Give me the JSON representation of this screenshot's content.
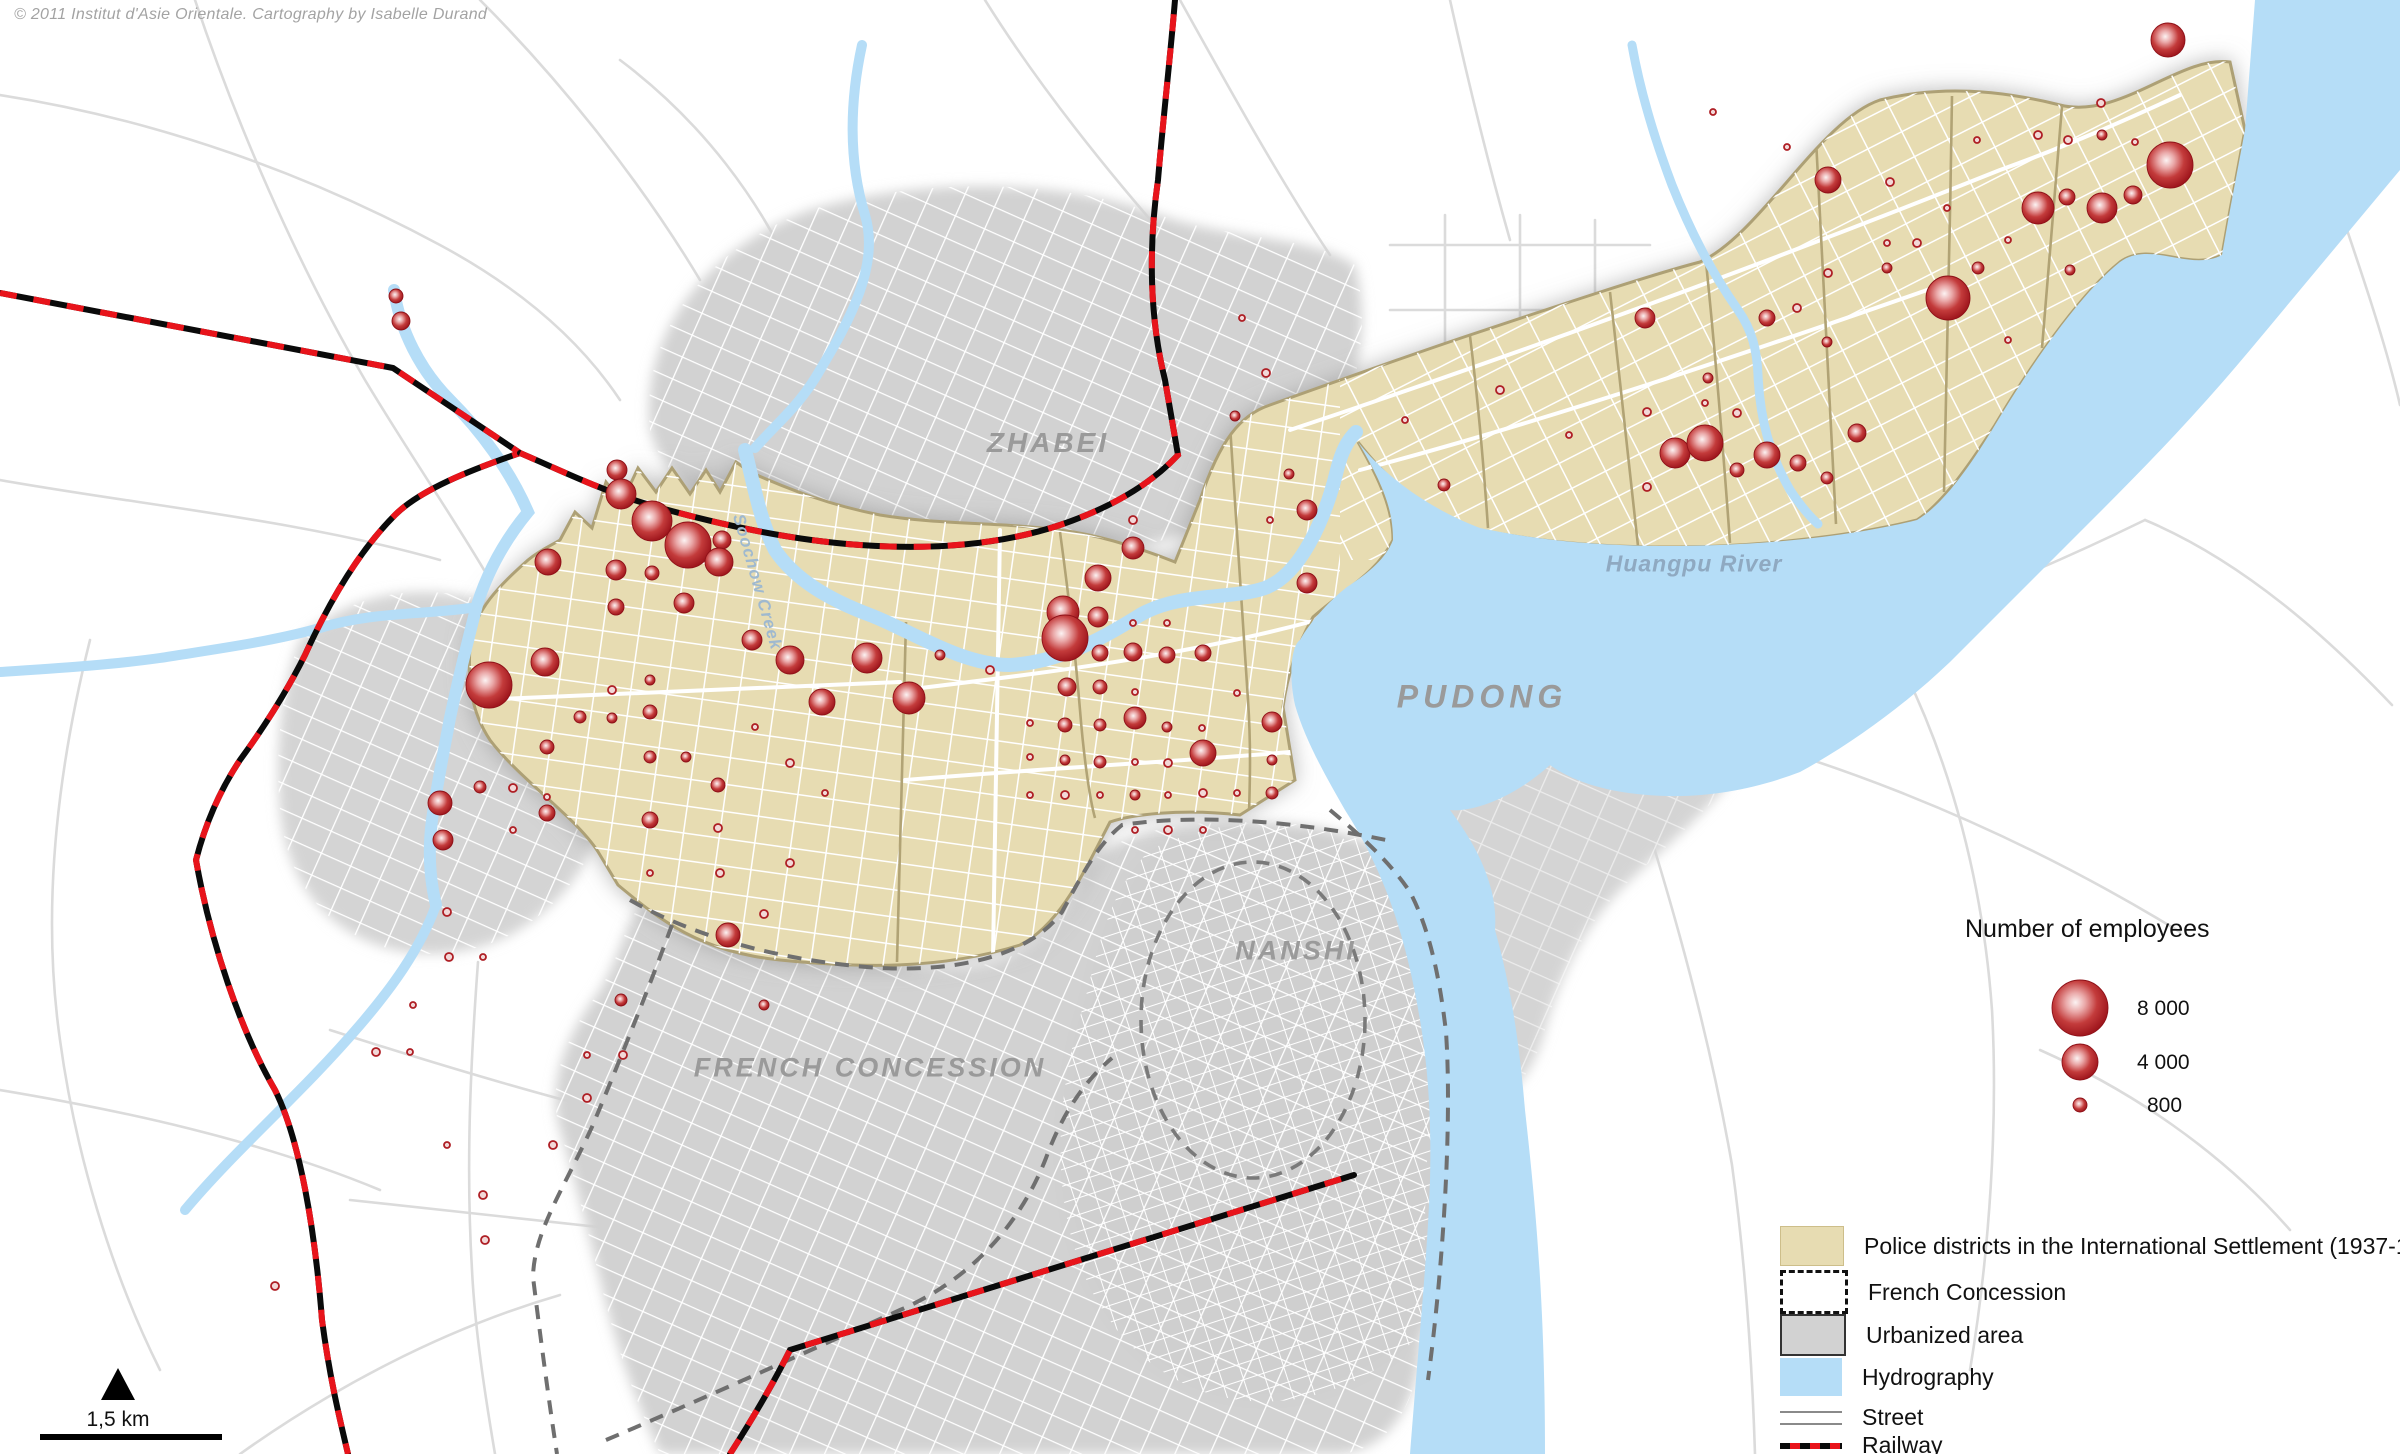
{
  "copyright": "© 2011 Institut d'Asie Orientale. Cartography by Isabelle Durand",
  "region_labels": {
    "zhabei": "ZHABEI",
    "pudong": "PUDONG",
    "nanshi": "NANSHI",
    "french_concession": "FRENCH CONCESSION",
    "huangpu_river": "Huangpu River",
    "soochow_creek": "Soochow Creek"
  },
  "size_legend": {
    "title": "Number of employees",
    "items": [
      {
        "label": "8 000",
        "r": 28
      },
      {
        "label": "4 000",
        "r": 18
      },
      {
        "label": "800",
        "r": 7
      }
    ]
  },
  "legend": {
    "items": [
      {
        "label": "Police districts in the International Settlement (1937-1945)",
        "swatch": "tan"
      },
      {
        "label": "French Concession",
        "swatch": "dashed"
      },
      {
        "label": "Urbanized area",
        "swatch": "gray"
      },
      {
        "label": "Hydrography",
        "swatch": "water"
      },
      {
        "label": "Street",
        "swatch": "street"
      },
      {
        "label": "Railway",
        "swatch": "railway"
      }
    ]
  },
  "scale_bar": {
    "label": "1,5 km"
  },
  "colors": {
    "settlement": "#E7DCB2",
    "settlement_border": "#ADA074",
    "urbanized": "#D2D2D2",
    "water": "#B5DDF7",
    "railway_red": "#E8141B",
    "circle_edge": "#9D141B",
    "label_gray": "#9A9A9A"
  },
  "circles": [
    [
      396,
      296,
      7
    ],
    [
      401,
      321,
      9
    ],
    [
      617,
      470,
      10
    ],
    [
      621,
      494,
      15
    ],
    [
      652,
      521,
      20
    ],
    [
      688,
      545,
      23
    ],
    [
      722,
      540,
      9
    ],
    [
      719,
      562,
      14
    ],
    [
      548,
      562,
      13
    ],
    [
      616,
      570,
      10
    ],
    [
      652,
      573,
      7
    ],
    [
      684,
      603,
      10
    ],
    [
      616,
      607,
      8
    ],
    [
      545,
      662,
      14
    ],
    [
      489,
      685,
      23
    ],
    [
      752,
      640,
      10
    ],
    [
      790,
      660,
      14
    ],
    [
      822,
      702,
      13
    ],
    [
      867,
      658,
      15
    ],
    [
      909,
      698,
      16
    ],
    [
      650,
      680,
      5
    ],
    [
      612,
      690,
      4
    ],
    [
      580,
      717,
      6
    ],
    [
      612,
      718,
      5
    ],
    [
      650,
      712,
      7
    ],
    [
      547,
      747,
      7
    ],
    [
      650,
      757,
      6
    ],
    [
      686,
      757,
      5
    ],
    [
      718,
      785,
      7
    ],
    [
      480,
      787,
      6
    ],
    [
      513,
      788,
      4
    ],
    [
      547,
      797,
      3
    ],
    [
      440,
      803,
      12
    ],
    [
      547,
      813,
      8
    ],
    [
      513,
      830,
      3
    ],
    [
      443,
      840,
      10
    ],
    [
      650,
      820,
      8
    ],
    [
      718,
      828,
      4
    ],
    [
      790,
      763,
      4
    ],
    [
      755,
      727,
      3
    ],
    [
      825,
      793,
      3
    ],
    [
      790,
      863,
      4
    ],
    [
      720,
      873,
      4
    ],
    [
      650,
      873,
      3
    ],
    [
      728,
      935,
      12
    ],
    [
      764,
      914,
      4
    ],
    [
      764,
      1005,
      5
    ],
    [
      621,
      1000,
      6
    ],
    [
      623,
      1055,
      4
    ],
    [
      587,
      1055,
      3
    ],
    [
      587,
      1098,
      4
    ],
    [
      553,
      1145,
      4
    ],
    [
      447,
      912,
      4
    ],
    [
      449,
      957,
      4
    ],
    [
      483,
      957,
      3
    ],
    [
      413,
      1005,
      3
    ],
    [
      376,
      1052,
      4
    ],
    [
      410,
      1052,
      3
    ],
    [
      447,
      1145,
      3
    ],
    [
      483,
      1195,
      4
    ],
    [
      485,
      1240,
      4
    ],
    [
      275,
      1286,
      4
    ],
    [
      940,
      655,
      5
    ],
    [
      990,
      670,
      4
    ],
    [
      1307,
      510,
      10
    ],
    [
      1133,
      520,
      4
    ],
    [
      1270,
      520,
      3
    ],
    [
      1133,
      548,
      11
    ],
    [
      1098,
      578,
      13
    ],
    [
      1063,
      612,
      16
    ],
    [
      1098,
      617,
      10
    ],
    [
      1065,
      638,
      23
    ],
    [
      1133,
      623,
      3
    ],
    [
      1167,
      623,
      3
    ],
    [
      1307,
      583,
      10
    ],
    [
      1100,
      653,
      8
    ],
    [
      1133,
      652,
      9
    ],
    [
      1167,
      655,
      8
    ],
    [
      1203,
      653,
      8
    ],
    [
      1067,
      687,
      9
    ],
    [
      1100,
      687,
      7
    ],
    [
      1135,
      692,
      3
    ],
    [
      1237,
      693,
      3
    ],
    [
      1030,
      723,
      3
    ],
    [
      1065,
      725,
      7
    ],
    [
      1100,
      725,
      6
    ],
    [
      1135,
      718,
      11
    ],
    [
      1167,
      727,
      5
    ],
    [
      1202,
      728,
      3
    ],
    [
      1272,
      722,
      10
    ],
    [
      1030,
      757,
      3
    ],
    [
      1065,
      760,
      5
    ],
    [
      1100,
      762,
      6
    ],
    [
      1135,
      762,
      3
    ],
    [
      1168,
      763,
      4
    ],
    [
      1203,
      753,
      13
    ],
    [
      1272,
      760,
      5
    ],
    [
      1030,
      795,
      3
    ],
    [
      1065,
      795,
      4
    ],
    [
      1100,
      795,
      3
    ],
    [
      1135,
      795,
      5
    ],
    [
      1168,
      795,
      3
    ],
    [
      1203,
      793,
      4
    ],
    [
      1237,
      793,
      3
    ],
    [
      1272,
      793,
      6
    ],
    [
      1135,
      830,
      3
    ],
    [
      1168,
      830,
      4
    ],
    [
      1203,
      830,
      3
    ],
    [
      1242,
      318,
      3
    ],
    [
      1266,
      373,
      4
    ],
    [
      1235,
      416,
      5
    ],
    [
      1289,
      474,
      5
    ],
    [
      1405,
      420,
      3
    ],
    [
      1444,
      485,
      6
    ],
    [
      1500,
      390,
      4
    ],
    [
      1569,
      435,
      3
    ],
    [
      1645,
      318,
      10
    ],
    [
      1647,
      412,
      4
    ],
    [
      1675,
      453,
      15
    ],
    [
      1705,
      443,
      18
    ],
    [
      1737,
      470,
      7
    ],
    [
      1767,
      455,
      13
    ],
    [
      1798,
      463,
      8
    ],
    [
      1827,
      478,
      6
    ],
    [
      1857,
      433,
      9
    ],
    [
      1737,
      413,
      4
    ],
    [
      1705,
      403,
      3
    ],
    [
      1647,
      487,
      4
    ],
    [
      1827,
      342,
      5
    ],
    [
      1767,
      318,
      8
    ],
    [
      1708,
      378,
      5
    ],
    [
      1797,
      308,
      4
    ],
    [
      1828,
      273,
      4
    ],
    [
      1887,
      268,
      5
    ],
    [
      1713,
      112,
      3
    ],
    [
      1787,
      147,
      3
    ],
    [
      1828,
      180,
      13
    ],
    [
      1890,
      182,
      4
    ],
    [
      1917,
      243,
      4
    ],
    [
      1887,
      243,
      3
    ],
    [
      1947,
      208,
      3
    ],
    [
      2008,
      240,
      3
    ],
    [
      1978,
      268,
      6
    ],
    [
      1948,
      298,
      22
    ],
    [
      2008,
      340,
      3
    ],
    [
      2038,
      208,
      16
    ],
    [
      2067,
      197,
      8
    ],
    [
      2070,
      270,
      5
    ],
    [
      2038,
      135,
      4
    ],
    [
      2068,
      140,
      4
    ],
    [
      1977,
      140,
      3
    ],
    [
      2101,
      103,
      4
    ],
    [
      2102,
      135,
      5
    ],
    [
      2135,
      142,
      3
    ],
    [
      2170,
      165,
      23
    ],
    [
      2133,
      195,
      9
    ],
    [
      2102,
      208,
      15
    ],
    [
      2168,
      40,
      17
    ]
  ]
}
